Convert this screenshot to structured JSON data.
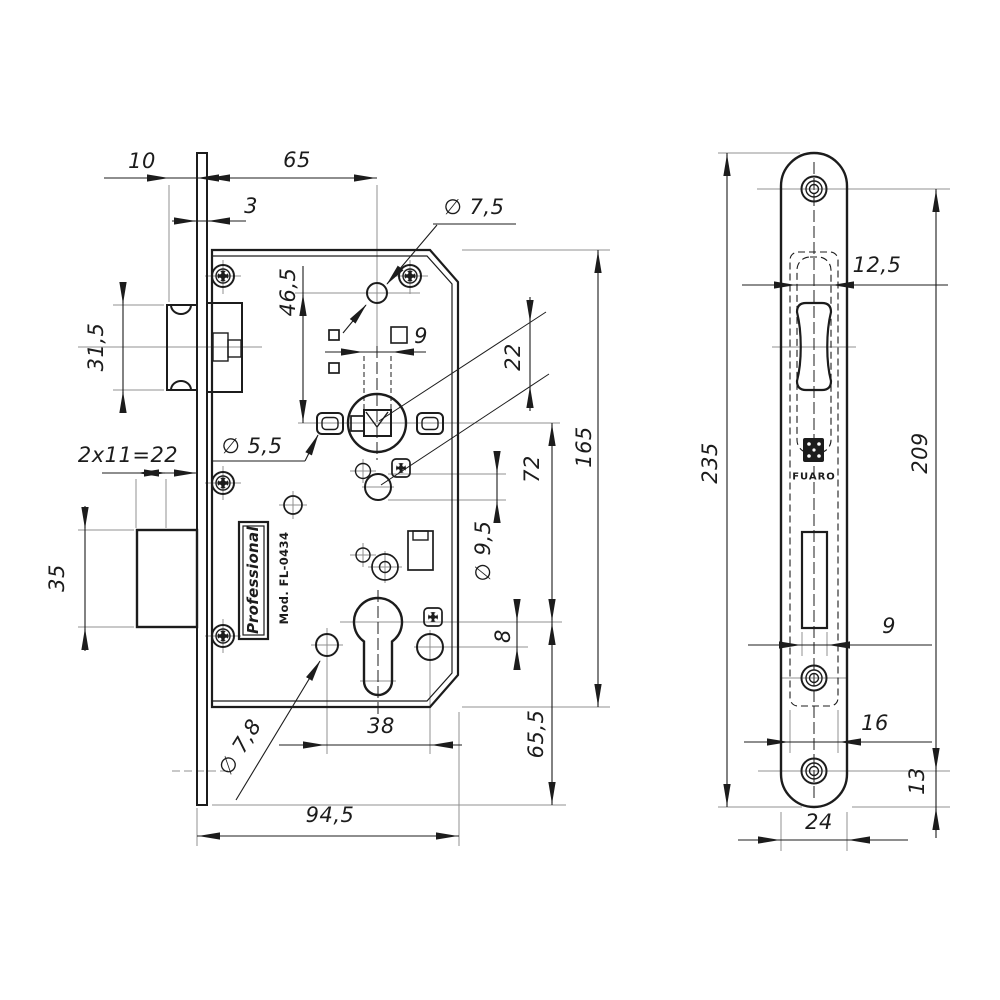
{
  "colors": {
    "line": "#1c1c1c",
    "thin_line": "#909090",
    "background": "#ffffff"
  },
  "product": {
    "series_label": "Professional",
    "model_label": "Mod. FL-0434",
    "brand_logo_text": "FUARO"
  },
  "front_view": {
    "dims": {
      "latch_projection": "10",
      "backset": "65",
      "faceplate_thickness": "3",
      "top_hole_offset": "46,5",
      "top_hole_dia": "∅ 7,5",
      "spindle_square": "9",
      "hub_to_hole_offset": "22",
      "latch_height": "31,5",
      "deadbolt_throw": "2x11=22",
      "fixing_hole_dia": "∅ 5,5",
      "deadbolt_height": "35",
      "hub_to_cylinder": "72",
      "case_height": "165",
      "hole_9_5_dia": "∅ 9,5",
      "offset_8": "8",
      "bottom_hole_dia": "∅ 7,8",
      "bottom_holes_span": "38",
      "case_depth": "94,5",
      "cylinder_to_bottom": "65,5"
    }
  },
  "side_view": {
    "dims": {
      "faceplate_length": "235",
      "screw_centers": "209",
      "latch_slot_width": "12,5",
      "deadbolt_slot_width": "9",
      "case_slot_width": "16",
      "bottom_screw_offset": "13",
      "faceplate_width": "24"
    }
  }
}
